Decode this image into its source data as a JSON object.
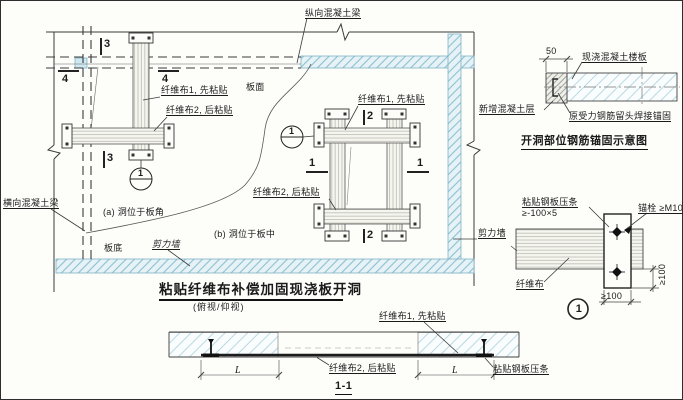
{
  "plan": {
    "title": "粘贴纤维布补偿加固现浇板开洞",
    "subtitle": "(俯视/仰视)",
    "beam_longitudinal": "纵向混凝土梁",
    "beam_transverse": "横向混凝土梁",
    "slab_top": "板面",
    "slab_bottom": "板底",
    "shear_wall_bottom": "剪力墙",
    "shear_wall_right": "剪力墙",
    "a": {
      "fiber1": "纤维布1, 先粘贴",
      "fiber2": "纤维布2, 后粘贴",
      "caption": "(a) 洞位于板角",
      "mark3": "3",
      "mark4": "4",
      "bubble": "1"
    },
    "b": {
      "fiber1": "纤维布1, 先粘贴",
      "fiber2": "纤维布2, 后粘贴",
      "caption": "(b) 洞位于板中",
      "mark1": "1",
      "mark2": "2",
      "bubble": "1"
    }
  },
  "anchor_detail": {
    "title": "开洞部位钢筋锚固示意图",
    "dim_50": "50",
    "slab": "现浇混凝土楼板",
    "new_layer": "新增混凝土层",
    "rebar": "原受力钢筋留头焊接锚固"
  },
  "plate_detail": {
    "plate_line1": "粘贴钢板压条",
    "plate_line2": "≥-100×5",
    "bolt": "锚栓 ≥M10",
    "fiber": "纤维布",
    "dim_vertical": "≥100",
    "dim_horizontal": "≥100",
    "bubble": "1"
  },
  "section": {
    "title": "1-1",
    "fiber1": "纤维布1, 先粘贴",
    "fiber2": "纤维布2, 后粘贴",
    "plate": "粘贴钢板压条",
    "dim_left": "L",
    "dim_right": "L"
  },
  "colors": {
    "line": "#3a3a3a",
    "wall_hatch": "#8cc0d2",
    "slab_hatch": "#aacfdc",
    "paper": "#fdfdfa"
  }
}
